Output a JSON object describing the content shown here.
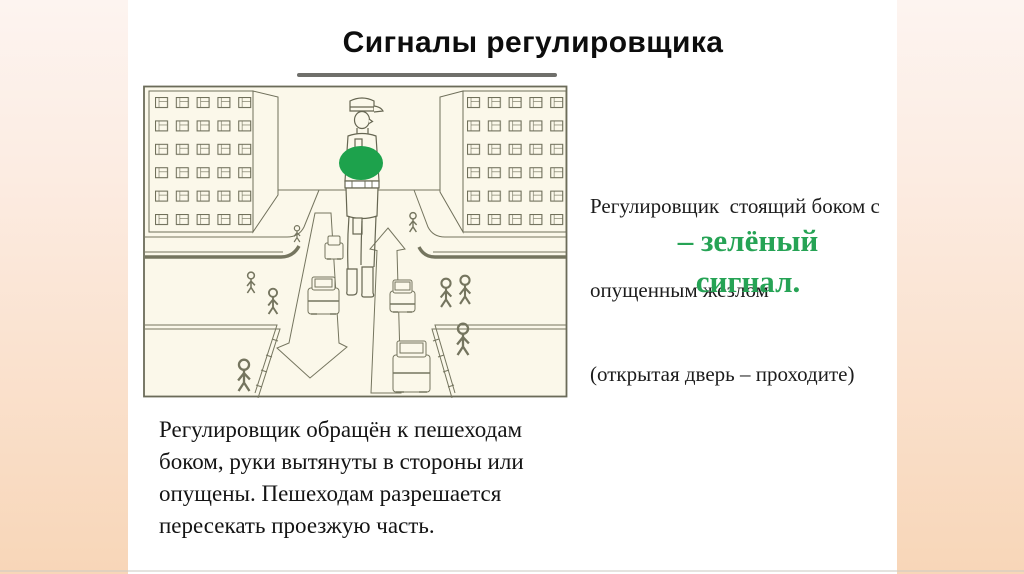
{
  "slide": {
    "title": "Сигналы регулировщика",
    "right_text": {
      "lines": [
        "Регулировщик  стоящий боком с",
        "опущенным жезлом",
        "(открытая дверь – проходите)"
      ],
      "highlight_lines": [
        "– зелёный",
        "сигнал."
      ],
      "highlight_color": "#26a355"
    },
    "caption": {
      "lines": [
        "Регулировщик обращён к пешеходам",
        "боком, руки вытянуты в стороны или",
        "опущены. Пешеходам разрешается",
        "пересекать проезжую часть."
      ]
    },
    "illustration": {
      "signal_color": "#1da24c",
      "background": "#fbf8ea",
      "line_color": "#75755f"
    },
    "theme": {
      "edge_gradient_top": "#fdf4f0",
      "edge_gradient_bottom": "#f8d6b8"
    }
  }
}
